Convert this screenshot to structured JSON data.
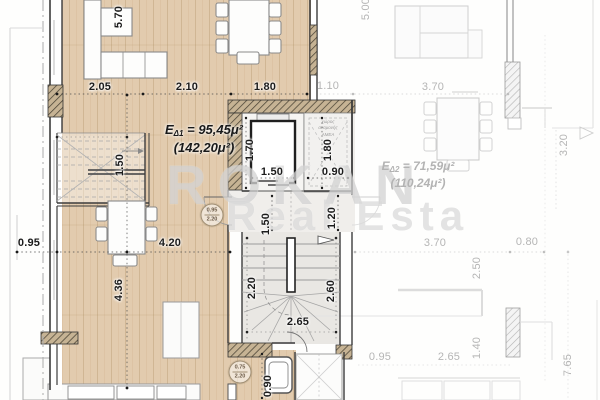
{
  "watermark": {
    "line1": "ROKAN",
    "line2": "Real Esta"
  },
  "plan": {
    "unit1_area": {
      "prefix": "E",
      "sub": "Δ1",
      "value": "= 95,45μ²",
      "total": "(142,20μ²)"
    },
    "unit2_area": {
      "prefix": "E",
      "sub": "Δ2",
      "value": "= 71,59μ²",
      "total": "(110,24μ²)"
    },
    "core_note": {
      "line1": "χώρος",
      "line2": "αναμονής",
      "line3": "ΑΜΕΑ"
    },
    "door_tags": [
      {
        "top": "0.95",
        "bottom": "2.20"
      },
      {
        "top": "0.75",
        "bottom": "2.20"
      }
    ]
  },
  "dims": {
    "active": {
      "sofa_span": "5.70",
      "living_a": "2.05",
      "living_b": "2.10",
      "living_c": "1.80",
      "lift_depth": "1.70",
      "lift_width": "1.50",
      "amea_depth": "1.80",
      "amea_width": "0.90",
      "inner_stairs": "1.50",
      "lobby_a": "1.50",
      "lobby_b": "1.20",
      "west_offset": "0.95",
      "kitchen_w": "4.20",
      "kitchen_h": "4.36",
      "stair_left": "2.20",
      "stair_right": "2.60",
      "stair_width": "2.65",
      "bath_w": "0.90"
    },
    "faded": {
      "entry_a": "1.10",
      "entry_b": "3.70",
      "north_span": "5.00",
      "east_h": "3.20",
      "south_a": "3.70",
      "south_b": "0.80",
      "south_c": "2.50",
      "south_d": "0.95",
      "south_e": "2.65",
      "south_f": "1.40",
      "east_total": "7.65"
    }
  },
  "colors": {
    "floor": "#e2cbae",
    "wall": "#3c3c3c",
    "faded_line": "#cccccc",
    "dim_text": "#1c1c1c",
    "faded_text": "#b5b5b5",
    "watermark": "#c1c1c1"
  }
}
